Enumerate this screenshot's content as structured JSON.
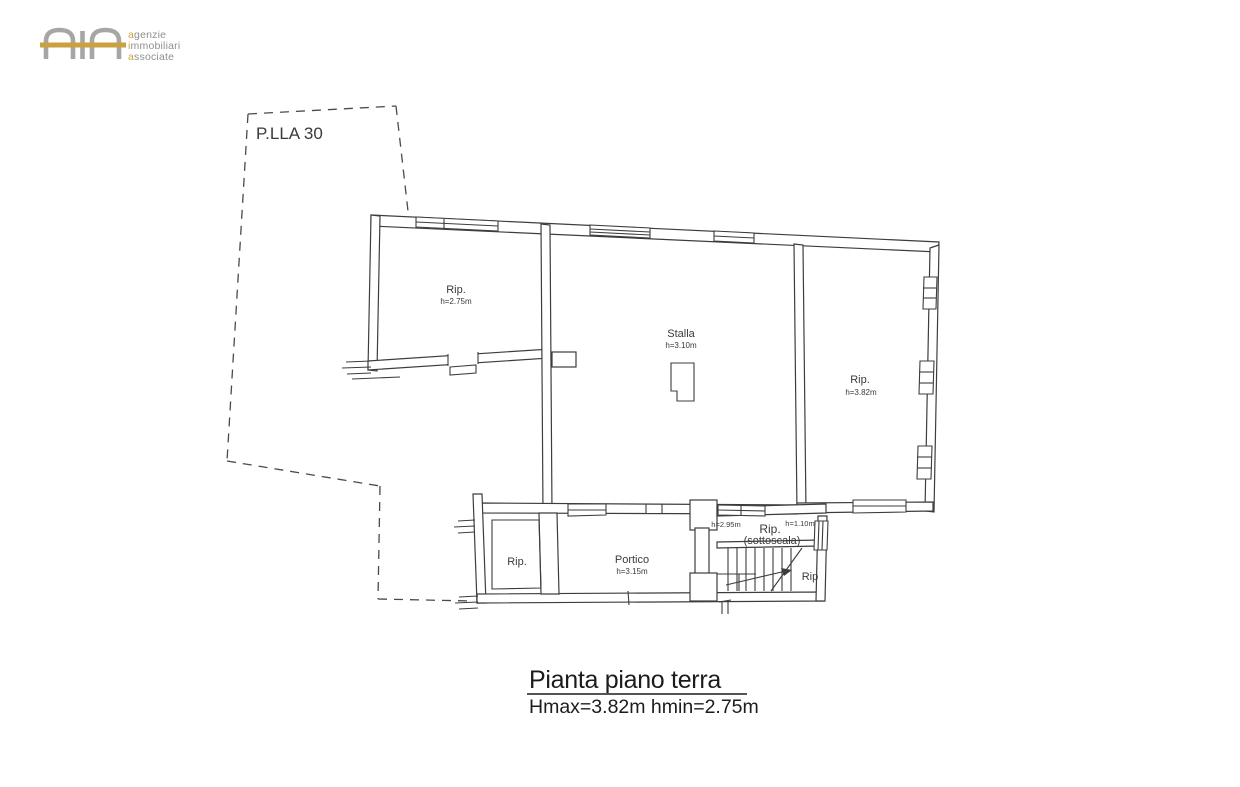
{
  "logo": {
    "gold": "#c9a23f",
    "gray": "#a6a6a6",
    "lines": [
      {
        "first": "a",
        "rest": "genzie"
      },
      {
        "first": "i",
        "rest": "mmobiliari"
      },
      {
        "first": "a",
        "rest": "ssociate"
      }
    ]
  },
  "parcel": {
    "label": "P.LLA 30"
  },
  "rooms": {
    "rip_nw": {
      "name": "Rip.",
      "height": "h=2.75m"
    },
    "stalla": {
      "name": "Stalla",
      "height": "h=3.10m"
    },
    "rip_e": {
      "name": "Rip.",
      "height": "h=3.82m"
    },
    "rip_sw": {
      "name": "Rip."
    },
    "portico": {
      "name": "Portico",
      "height": "h=3.15m"
    },
    "sottoscala": {
      "name": "Rip.",
      "qualifier": "(sottoscala)",
      "height_left": "h=2.95m",
      "height_right": "h=1.10m"
    },
    "rip_stairs": {
      "name": "Rip"
    }
  },
  "caption": {
    "title": "Pianta piano terra",
    "subtitle": "Hmax=3.82m hmin=2.75m"
  },
  "colors": {
    "drawing_line": "#3d3d3d"
  }
}
